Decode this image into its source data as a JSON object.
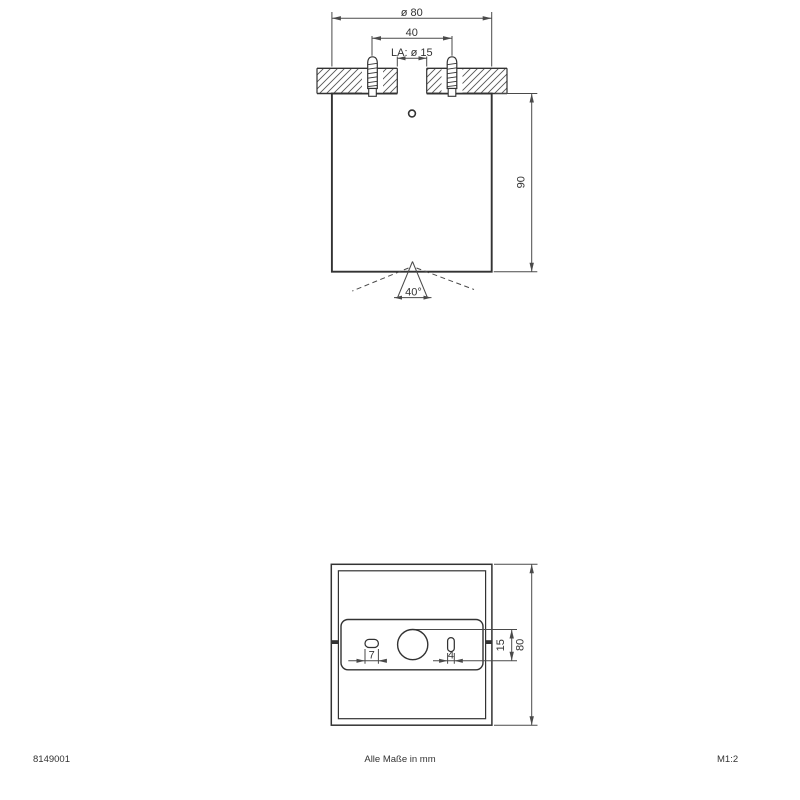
{
  "side_view": {
    "dim_diameter": "ø 80",
    "dim_screw_spacing": "40",
    "dim_cutout": "LA: ø 15",
    "dim_height": "90",
    "dim_beam_angle": "40°"
  },
  "bottom_view": {
    "dim_slot_left_width": "7",
    "dim_slot_right_width": "4",
    "dim_hole_diameter": "15",
    "dim_overall_width": "80"
  },
  "footer": {
    "article_number": "8149001",
    "note": "Alle Maße in mm",
    "scale": "M1:2"
  },
  "colors": {
    "line": "#333333",
    "dim_line": "#4a4a4a",
    "hatch": "#555555",
    "background": "#ffffff"
  }
}
